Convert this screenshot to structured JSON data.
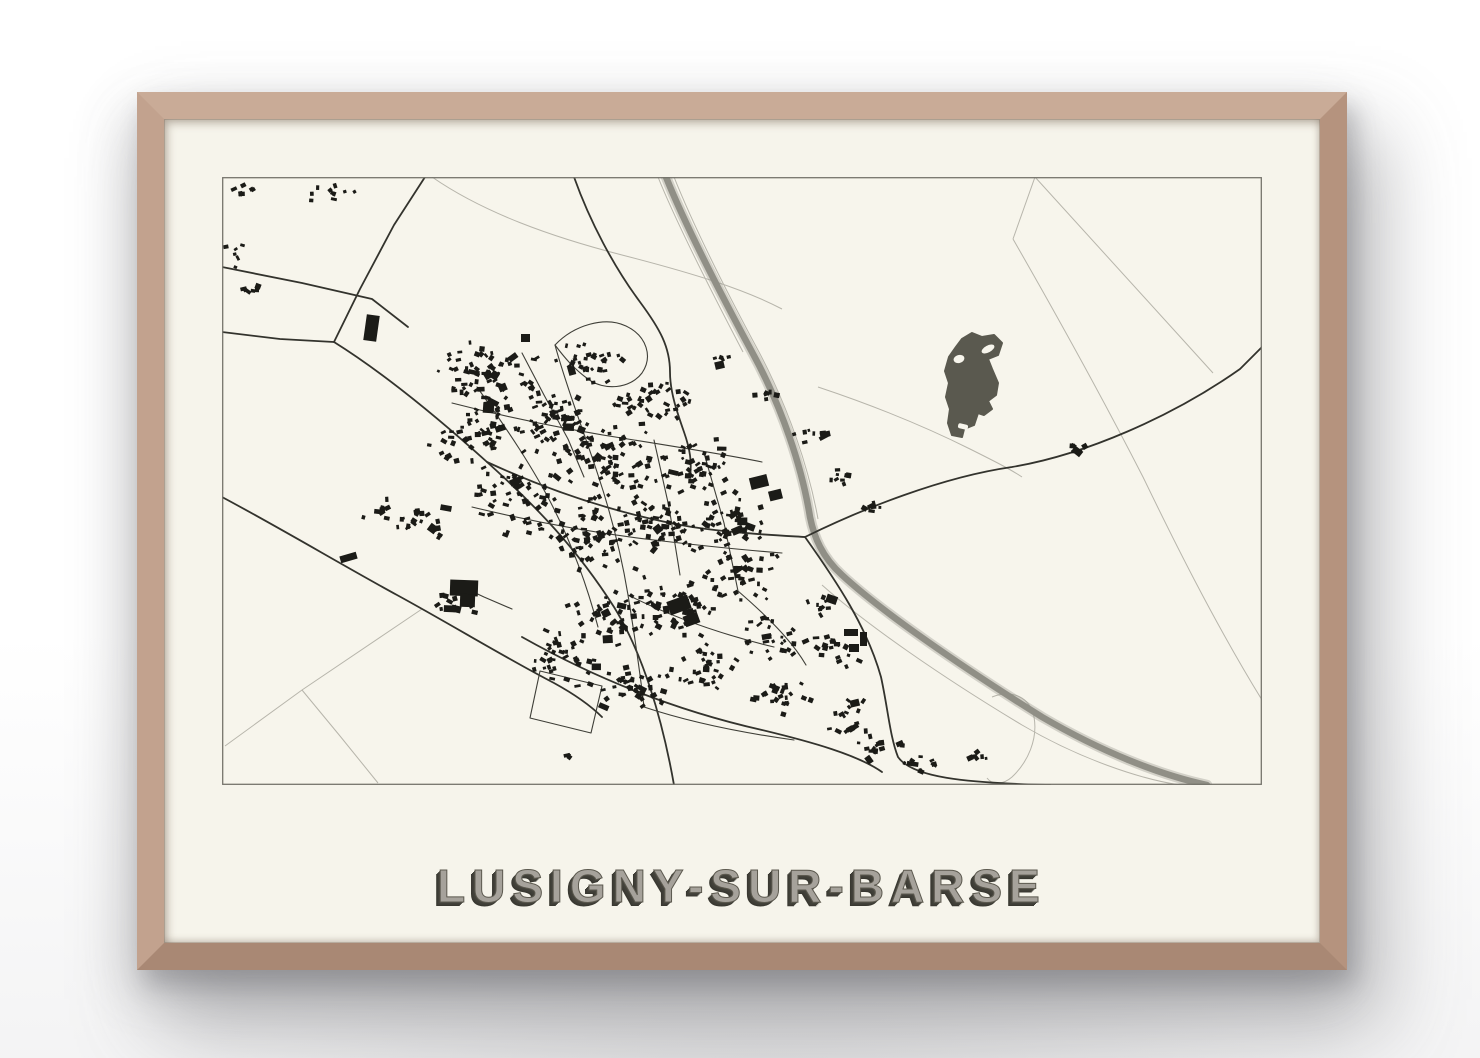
{
  "poster": {
    "title": "LUSIGNY-SUR-BARSE"
  },
  "colors": {
    "wall": "#ffffff",
    "frame_wood": "#bd9c88",
    "poster_paper": "#f6f4eb",
    "map_background": "#f7f5ec",
    "map_border": "#75746c",
    "road_dark": "#33332d",
    "street": "#3e3e37",
    "road_faint": "#b7b5ab",
    "highway": "#908f86",
    "building": "#1b1b17",
    "woodland_pond": "#5a594f",
    "title_fill": "#a6a29b",
    "title_shadow": "#3c3b34"
  },
  "map_geometry": {
    "seed": 1337,
    "view": {
      "w": 1040,
      "h": 608
    },
    "faint_roads": [
      "M813,0 L791,62",
      "M813,0 L991,196",
      "M791,62 C830,130 880,220 921,300 C950,360 992,445 1040,523",
      "M200,432 L80,513 L3,569",
      "M80,513 L118,559 L156,606",
      "M210,0 C262,36 330,60 400,78 C470,96 522,112 560,132",
      "M452,0 C470,45 502,110 537,175 C567,232 587,292 596,342",
      "M436,0 C454,45 487,110 521,175",
      "M596,210 C650,228 700,248 748,272 C772,284 788,292 800,300",
      "M600,408 C645,448 720,500 800,548 C858,582 918,602 958,608",
      "M770,520 C790,512 808,520 812,540 C816,562 806,585 790,600 C781,608 770,608 765,601"
    ],
    "dark_roads": [
      "M203,0 L172,48 L138,112 L112,165",
      "M0,90 L80,106 L150,122 L186,150",
      "M0,155 L58,162 L112,165",
      "M112,165 C160,195 215,240 265,285 C315,330 355,372 392,430 C420,475 440,540 452,608",
      "M0,320 C60,352 120,388 175,418 C230,448 282,480 332,506 C352,517 368,528 380,540",
      "M265,285 C330,315 400,338 470,350 C510,356 550,358 583,360",
      "M583,360 C640,332 720,300 790,290 C862,278 950,240 1018,192 L1040,170",
      "M583,360 C615,405 645,450 659,500 C666,532 668,560 676,580 C690,600 740,606 828,608",
      "M300,460 C380,505 460,535 540,553 C590,565 636,578 660,595",
      "M352,0 C368,45 392,90 418,125 C438,152 448,170 448,195 C448,215 455,235 462,255 C468,272 470,285 468,300"
    ],
    "streets": [
      "M333,168 C345,212 362,255 376,298 C390,340 400,382 406,418 C412,455 418,495 422,530",
      "M255,210 C285,252 312,292 332,332 C352,372 366,412 376,450",
      "M300,176 L322,218 L346,262 L362,300",
      "M333,168 C352,148 383,139 404,149 C425,159 431,180 420,196 C408,212 382,214 366,202 C352,192 342,180 333,168",
      "M230,226 C292,242 352,254 412,263 C462,271 506,278 540,285",
      "M250,330 C312,345 372,356 432,363 C482,369 522,373 560,376",
      "M432,263 L447,330 L458,398",
      "M482,276 L502,346 L516,414",
      "M406,418 C452,441 502,458 552,470",
      "M422,530 C470,546 522,556 572,563",
      "M318,494 L380,509 L369,556 L308,541 Z",
      "M516,414 C546,440 570,464 584,488",
      "M230,405 L262,420 L290,432"
    ],
    "highway": {
      "path": "M444,0 C462,45 495,110 530,175 C560,230 580,290 588,340 C592,360 600,380 620,398 C660,435 740,490 820,540 C880,575 938,598 985,608",
      "width": 6.5
    },
    "pond": {
      "path": "M750,156 L760,160 L772,158 L780,166 L776,178 L766,182 L770,192 L776,206 L774,218 L766,224 L770,232 L762,238 L756,236 L752,248 L742,252 L740,260 L730,258 L726,246 L728,232 L724,220 L727,206 L723,194 L727,180 L734,170 L740,162 Z",
      "holes": [
        {
          "type": "ellipse",
          "cx": 766,
          "cy": 172,
          "rx": 7,
          "ry": 3.4,
          "rot": -28
        },
        {
          "type": "ellipse",
          "cx": 737,
          "cy": 182,
          "rx": 5.5,
          "ry": 4,
          "rot": -15
        },
        {
          "type": "rect",
          "x": 736,
          "y": 247,
          "w": 10,
          "h": 5,
          "rot": 14
        }
      ]
    },
    "large_buildings": [
      {
        "x": 143,
        "y": 138,
        "w": 13,
        "h": 26,
        "rot": 8
      },
      {
        "x": 228,
        "y": 403,
        "w": 28,
        "h": 16,
        "rot": 2
      },
      {
        "x": 238,
        "y": 417,
        "w": 15,
        "h": 13,
        "rot": 2
      },
      {
        "x": 446,
        "y": 421,
        "w": 22,
        "h": 14,
        "rot": -20
      },
      {
        "x": 462,
        "y": 437,
        "w": 15,
        "h": 11,
        "rot": -20
      },
      {
        "x": 528,
        "y": 299,
        "w": 18,
        "h": 12,
        "rot": -14
      },
      {
        "x": 547,
        "y": 313,
        "w": 13,
        "h": 10,
        "rot": -14
      },
      {
        "x": 261,
        "y": 226,
        "w": 11,
        "h": 10,
        "rot": 4
      },
      {
        "x": 118,
        "y": 377,
        "w": 17,
        "h": 7,
        "rot": -16
      },
      {
        "x": 622,
        "y": 452,
        "w": 14,
        "h": 7,
        "rot": 0
      },
      {
        "x": 638,
        "y": 455,
        "w": 7,
        "h": 14,
        "rot": 0
      },
      {
        "x": 627,
        "y": 467,
        "w": 10,
        "h": 8,
        "rot": 0
      },
      {
        "x": 299,
        "y": 157,
        "w": 9,
        "h": 8,
        "rot": 0
      }
    ],
    "building_clusters": [
      {
        "x": 108,
        "y": 18,
        "rx": 30,
        "ry": 12,
        "n": 10
      },
      {
        "x": 26,
        "y": 12,
        "rx": 22,
        "ry": 8,
        "n": 7
      },
      {
        "x": 12,
        "y": 78,
        "rx": 12,
        "ry": 18,
        "n": 6
      },
      {
        "x": 30,
        "y": 112,
        "rx": 16,
        "ry": 10,
        "n": 6
      },
      {
        "x": 268,
        "y": 196,
        "rx": 55,
        "ry": 38,
        "n": 60
      },
      {
        "x": 330,
        "y": 242,
        "rx": 60,
        "ry": 42,
        "n": 75
      },
      {
        "x": 394,
        "y": 290,
        "rx": 60,
        "ry": 42,
        "n": 75
      },
      {
        "x": 248,
        "y": 262,
        "rx": 45,
        "ry": 35,
        "n": 40
      },
      {
        "x": 300,
        "y": 322,
        "rx": 55,
        "ry": 38,
        "n": 55
      },
      {
        "x": 368,
        "y": 362,
        "rx": 55,
        "ry": 38,
        "n": 60
      },
      {
        "x": 440,
        "y": 352,
        "rx": 50,
        "ry": 35,
        "n": 55
      },
      {
        "x": 470,
        "y": 292,
        "rx": 45,
        "ry": 32,
        "n": 45
      },
      {
        "x": 430,
        "y": 230,
        "rx": 45,
        "ry": 30,
        "n": 38
      },
      {
        "x": 368,
        "y": 186,
        "rx": 42,
        "ry": 26,
        "n": 30
      },
      {
        "x": 510,
        "y": 342,
        "rx": 40,
        "ry": 30,
        "n": 40
      },
      {
        "x": 520,
        "y": 402,
        "rx": 45,
        "ry": 32,
        "n": 40
      },
      {
        "x": 452,
        "y": 432,
        "rx": 50,
        "ry": 34,
        "n": 48
      },
      {
        "x": 390,
        "y": 442,
        "rx": 45,
        "ry": 32,
        "n": 38
      },
      {
        "x": 342,
        "y": 482,
        "rx": 45,
        "ry": 30,
        "n": 36
      },
      {
        "x": 412,
        "y": 512,
        "rx": 45,
        "ry": 28,
        "n": 40
      },
      {
        "x": 482,
        "y": 492,
        "rx": 40,
        "ry": 28,
        "n": 32
      },
      {
        "x": 542,
        "y": 462,
        "rx": 35,
        "ry": 25,
        "n": 26
      },
      {
        "x": 562,
        "y": 522,
        "rx": 35,
        "ry": 22,
        "n": 22
      },
      {
        "x": 612,
        "y": 472,
        "rx": 30,
        "ry": 22,
        "n": 20
      },
      {
        "x": 622,
        "y": 542,
        "rx": 32,
        "ry": 20,
        "n": 18
      },
      {
        "x": 660,
        "y": 572,
        "rx": 28,
        "ry": 18,
        "n": 14
      },
      {
        "x": 700,
        "y": 586,
        "rx": 22,
        "ry": 12,
        "n": 9
      },
      {
        "x": 196,
        "y": 346,
        "rx": 32,
        "ry": 20,
        "n": 22
      },
      {
        "x": 160,
        "y": 332,
        "rx": 20,
        "ry": 12,
        "n": 8
      },
      {
        "x": 620,
        "y": 300,
        "rx": 18,
        "ry": 12,
        "n": 8
      },
      {
        "x": 650,
        "y": 332,
        "rx": 15,
        "ry": 10,
        "n": 6
      },
      {
        "x": 852,
        "y": 272,
        "rx": 16,
        "ry": 8,
        "n": 6
      },
      {
        "x": 590,
        "y": 256,
        "rx": 20,
        "ry": 12,
        "n": 8
      },
      {
        "x": 546,
        "y": 216,
        "rx": 18,
        "ry": 10,
        "n": 7
      },
      {
        "x": 500,
        "y": 182,
        "rx": 15,
        "ry": 9,
        "n": 5
      },
      {
        "x": 232,
        "y": 430,
        "rx": 25,
        "ry": 14,
        "n": 11
      },
      {
        "x": 758,
        "y": 578,
        "rx": 16,
        "ry": 9,
        "n": 6
      },
      {
        "x": 340,
        "y": 580,
        "rx": 12,
        "ry": 7,
        "n": 3
      },
      {
        "x": 600,
        "y": 430,
        "rx": 20,
        "ry": 14,
        "n": 10
      }
    ]
  }
}
